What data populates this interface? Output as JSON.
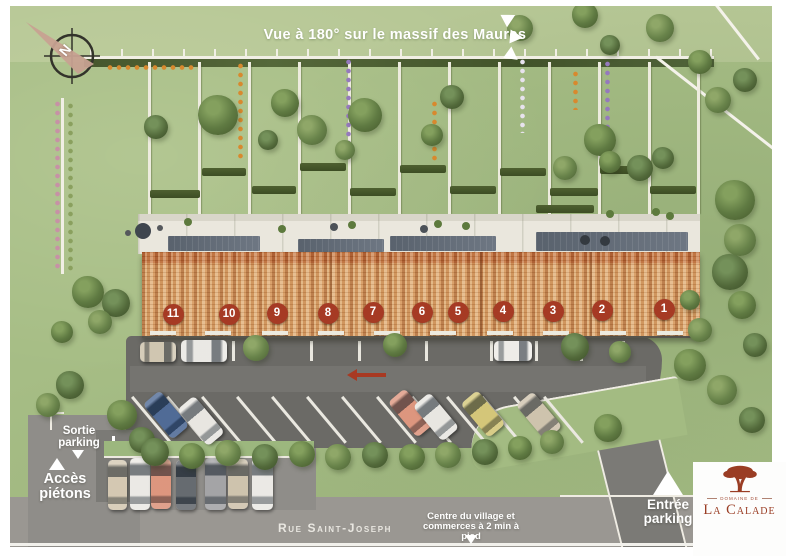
{
  "banner": {
    "title": "Vue à 180° sur le massif des Maures"
  },
  "compass": {
    "north": "N"
  },
  "houses": {
    "numbers": [
      "11",
      "10",
      "9",
      "8",
      "7",
      "6",
      "5",
      "4",
      "3",
      "2",
      "1"
    ]
  },
  "wayfinding": {
    "sortie": {
      "line1": "Sortie",
      "line2": "parking"
    },
    "acces": {
      "line1": "Accès",
      "line2": "piétons"
    },
    "entree": {
      "line1": "Entrée",
      "line2": "parking"
    },
    "village": {
      "line1": "Centre du village et",
      "line2": "commerces à 2 min à pied"
    }
  },
  "street": {
    "name": "Rue Saint-Joseph"
  },
  "logo": {
    "overline": "Domaine de",
    "name": "La Calade"
  },
  "colors": {
    "badge": "#a63a24",
    "roof": "#d99f66",
    "arrow": "#a83922",
    "logo_red": "#9a3d24",
    "lawn": "#a6bd85"
  }
}
